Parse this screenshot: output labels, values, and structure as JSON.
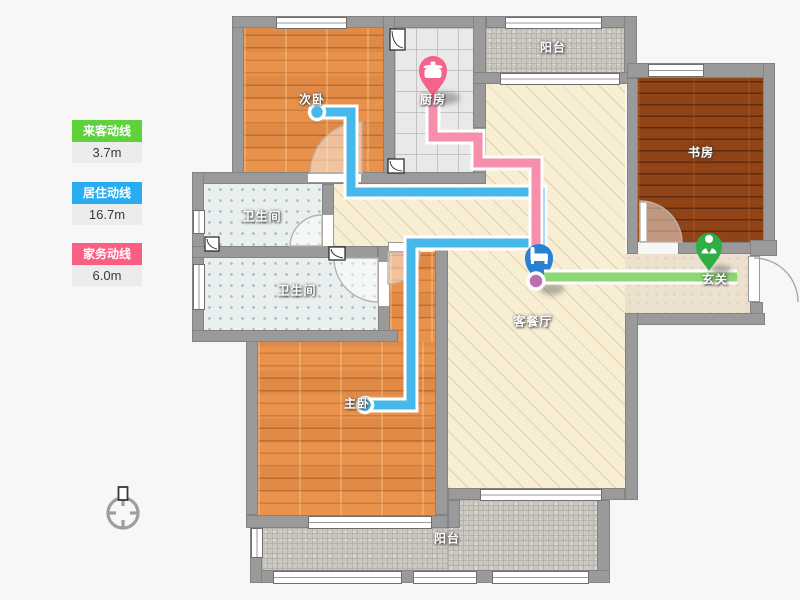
{
  "legend": {
    "items": [
      {
        "label": "来客动线",
        "value": "3.7m",
        "color": "#5fd13b"
      },
      {
        "label": "居住动线",
        "value": "16.7m",
        "color": "#2aacf0"
      },
      {
        "label": "家务动线",
        "value": "6.0m",
        "color": "#f85f83"
      }
    ]
  },
  "rooms": {
    "bedroom2": "次卧",
    "kitchen": "厨房",
    "balcony_top": "阳台",
    "study": "书房",
    "bath1": "卫生间",
    "bath2": "卫生间",
    "master_bedroom": "主卧",
    "living_dining": "客餐厅",
    "entry": "玄关",
    "balcony_bottom": "阳台"
  },
  "markers": {
    "kitchen": {
      "icon": "pot-icon",
      "color": "#f4638c"
    },
    "living": {
      "icon": "bed-icon",
      "color": "#2b80d2"
    },
    "entry": {
      "icon": "person-icon",
      "color": "#2fae47"
    }
  },
  "lines": {
    "guest_line_color": "#8ed672",
    "residence_line_color": "#47b8ea",
    "housework_line_color": "#f58fab"
  }
}
